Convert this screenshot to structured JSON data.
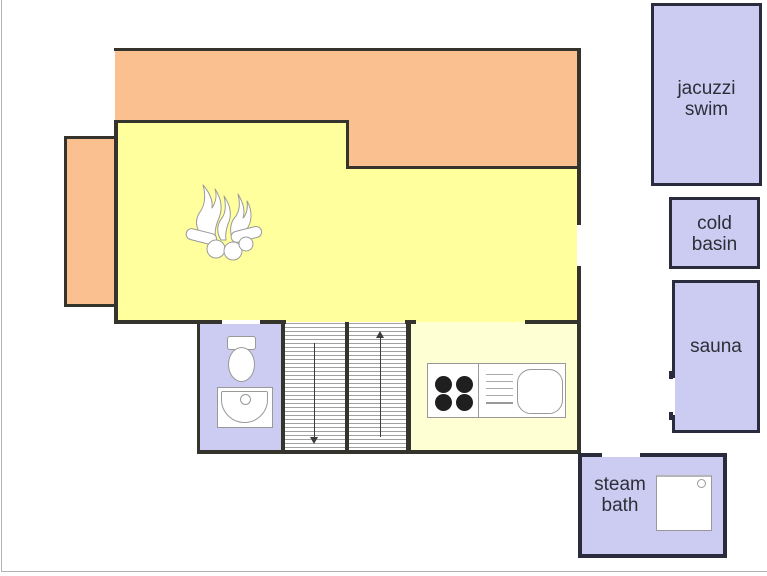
{
  "canvas": {
    "width": 767,
    "height": 576
  },
  "colors": {
    "wall": "#34342c",
    "room_border": "#2b2b3e",
    "orange_area": "#fac08f",
    "living_yellow": "#ffff9e",
    "kitchen_pale_yellow": "#ffffd4",
    "lavender_room": "#ccccf2",
    "fixture_outline": "#999999",
    "stair_tread": "#a0a0a0",
    "arrow": "#3c3c3c",
    "page_edge": "#b3b3b3",
    "label_text": "#2e2e38"
  },
  "labels": {
    "jacuzzi_swim": {
      "line1": "jacuzzi",
      "line2": "swim"
    },
    "cold_basin": {
      "line1": "cold",
      "line2": "basin"
    },
    "sauna": {
      "line1": "sauna"
    },
    "steam_bath": {
      "line1": "steam",
      "line2": "bath"
    }
  },
  "icons": [
    "fireplace-icon",
    "toilet-icon",
    "washbasin-icon",
    "stove-burners-icon",
    "drainboard-icon",
    "kitchen-sink-icon",
    "shower-tray-icon",
    "stairs-down-arrow-icon",
    "stairs-up-arrow-icon"
  ]
}
